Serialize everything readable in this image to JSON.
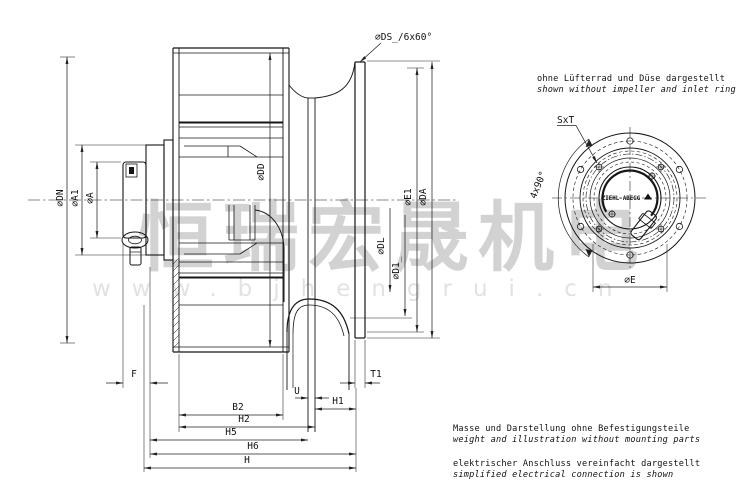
{
  "watermark": {
    "brand": "恒瑞宏晟机电",
    "url": "www.bjhengrui.cn"
  },
  "side_view": {
    "dims": {
      "ds": "⌀DS_/6x60°",
      "dn": "⌀DN",
      "a1": "⌀A1",
      "a": "⌀A",
      "dd": "⌀DD",
      "dl": "⌀DL",
      "d1": "⌀D1_",
      "e1": "⌀E1",
      "da": "⌀DA",
      "f": "F",
      "b2": "B2",
      "h2": "H2",
      "h5": "H5",
      "h6": "H6",
      "h": "H",
      "u": "U",
      "h1": "H1",
      "t1": "T1"
    }
  },
  "rear_view": {
    "note_de": "ohne Lüfterrad und Düse dargestellt",
    "note_en": "shown without impeller and inlet ring",
    "dims": {
      "sxt": "SxT",
      "angle": "4x90°",
      "e": "⌀E"
    },
    "logo": "ZIEHL-ABEGG"
  },
  "notes": {
    "weight_de": "Masse und Darstellung ohne Befestigungsteile",
    "weight_en": "weight and illustration without mounting parts",
    "electric_de": "elektrischer Anschluss vereinfacht dargestellt",
    "electric_en": "simplified electrical connection is shown"
  },
  "colors": {
    "line": "#161616",
    "watermark": "#d2d2d2",
    "watermark_url": "#e2e2e2"
  }
}
